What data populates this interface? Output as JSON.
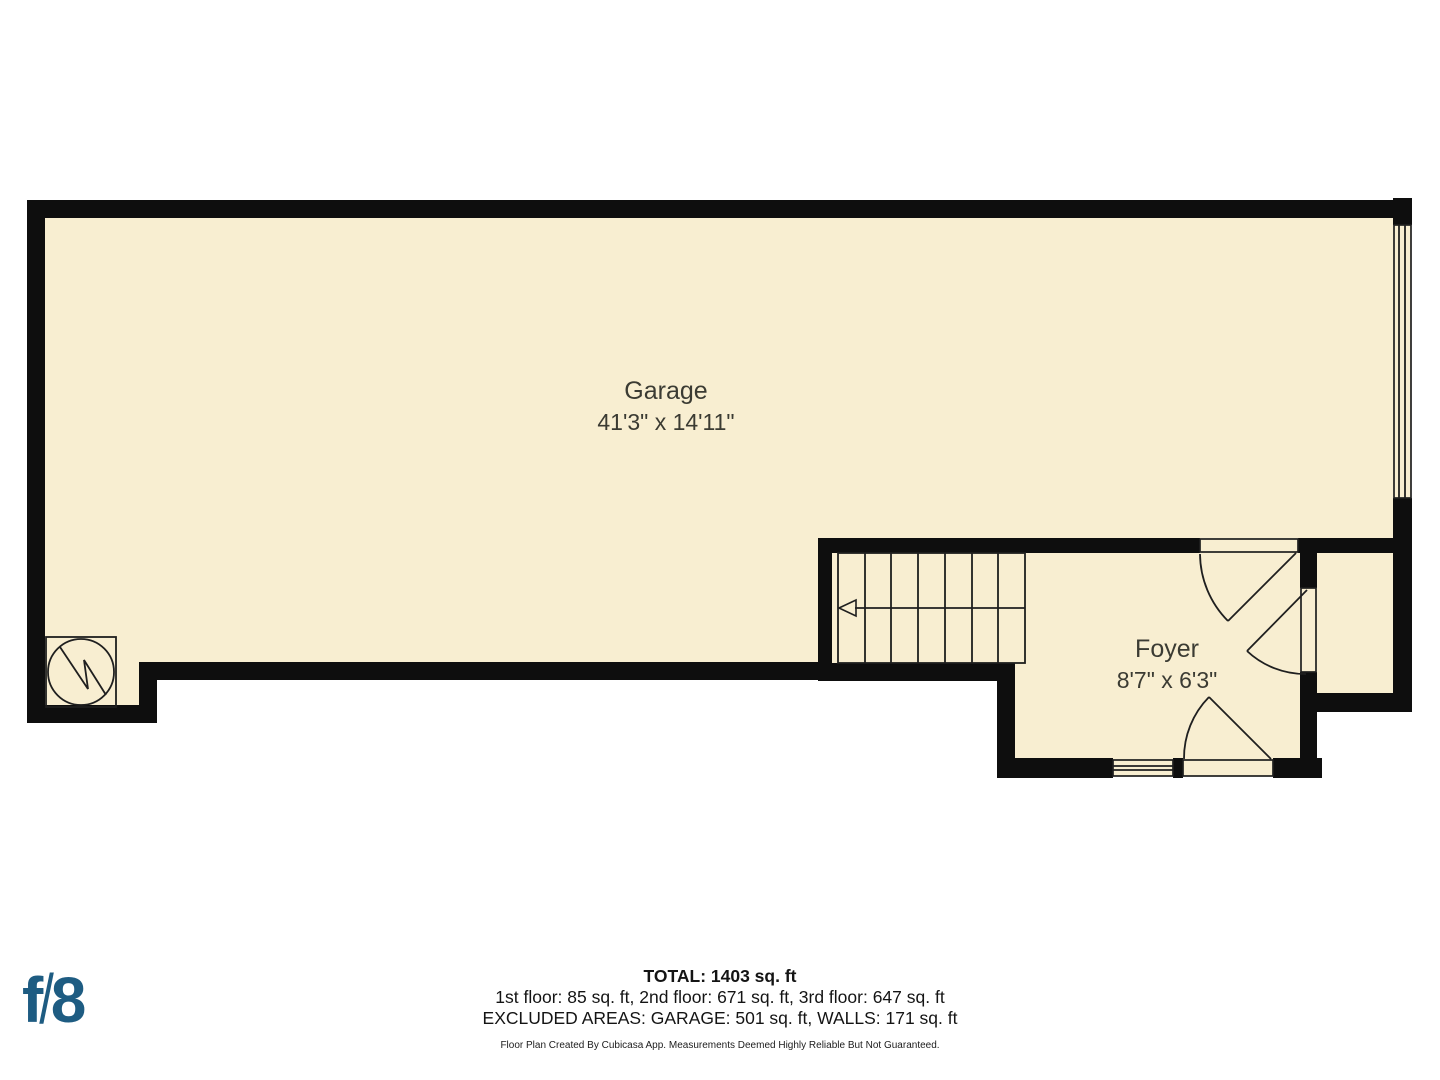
{
  "floor_plan": {
    "rooms": [
      {
        "name": "Garage",
        "dimensions": "41'3\" x 14'11\""
      },
      {
        "name": "Foyer",
        "dimensions": "8'7\" x 6'3\""
      }
    ],
    "symbols": [
      "water-heater",
      "stairs-with-up-arrow",
      "garage-door",
      "entry-door",
      "interior-door",
      "window"
    ]
  },
  "summary": {
    "total": "TOTAL: 1403 sq. ft",
    "floors": "1st floor: 85 sq. ft, 2nd floor: 671 sq. ft, 3rd floor: 647 sq. ft",
    "excluded": "EXCLUDED AREAS: GARAGE: 501 sq. ft, WALLS: 171 sq. ft",
    "disclaimer": "Floor Plan Created By Cubicasa App. Measurements Deemed Highly Reliable But Not Guaranteed."
  },
  "branding": {
    "f": "f",
    "slash": "/",
    "eight": "8"
  },
  "colors": {
    "floor": "#f8eed1",
    "wall": "#0e0e0e",
    "line": "#1f1f1f",
    "label_text": "#3b3b33",
    "summary_text": "#141414",
    "logo_blue": "#1e5c82",
    "background": "#ffffff"
  }
}
